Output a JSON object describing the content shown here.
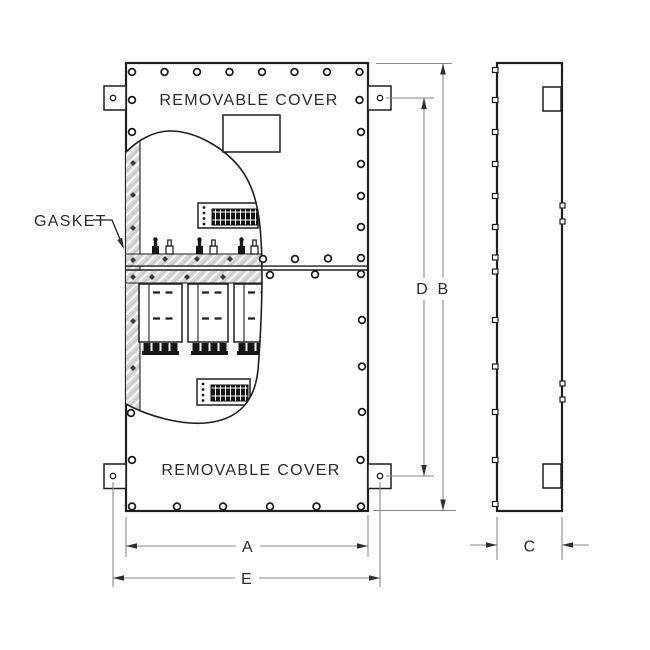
{
  "labels": {
    "top_cover": "REMOVABLE COVER",
    "bottom_cover": "REMOVABLE COVER",
    "gasket": "GASKET"
  },
  "dimensions": {
    "a": "A",
    "b": "B",
    "c": "C",
    "d": "D",
    "e": "E"
  },
  "colors": {
    "line": "#1f1f1f",
    "dimension_line": "#8a8a8a",
    "gasket_fill": "#d8d8d8",
    "background": "#ffffff"
  }
}
